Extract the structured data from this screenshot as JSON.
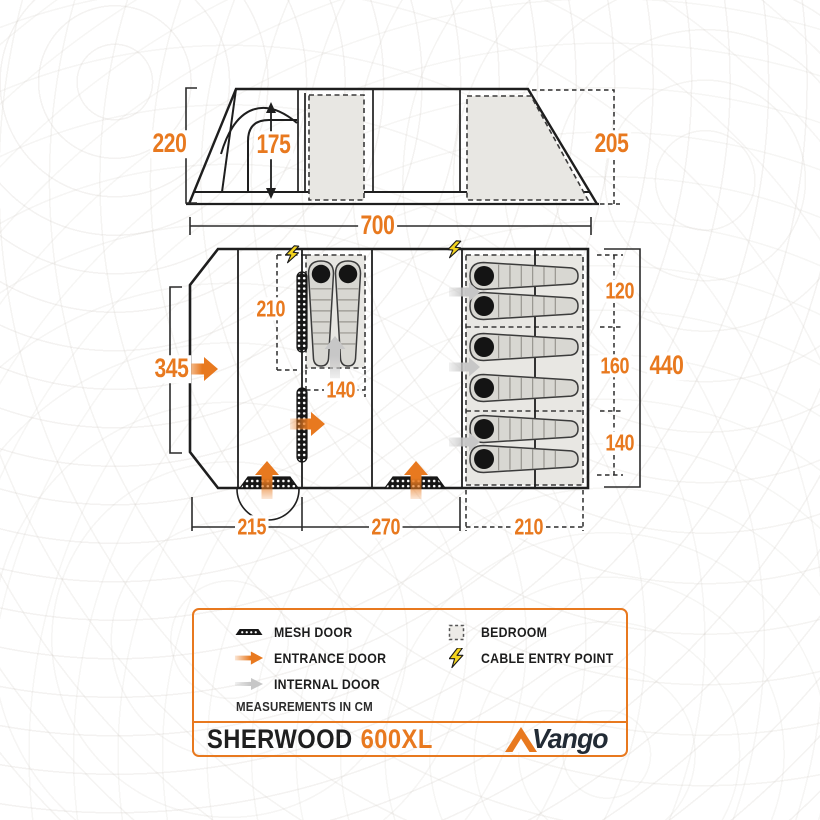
{
  "colors": {
    "accent_orange": "#e8791f",
    "bolt_yellow": "#f4d41f",
    "internal_gray": "#c7c7c7",
    "bedroom_fill": "#e8e7e3",
    "line_black": "#1e1e1e"
  },
  "icons": {
    "mesh_door": "mesh-door-icon",
    "entrance_door": "entrance-door-arrow-icon",
    "internal_door": "internal-door-arrow-icon",
    "bedroom": "bedroom-dashed-square-icon",
    "cable_entry": "lightning-bolt-icon",
    "brand_mark": "vango-triangle-icon"
  },
  "dims": {
    "elev_left_height": "220",
    "elev_inner_height": "175",
    "elev_right_height": "205",
    "total_width": "700",
    "front_width": "345",
    "bedroom_left_depth": "210",
    "bedroom_left_width": "140",
    "bottom_porch": "215",
    "bottom_living": "270",
    "bottom_bedroom": "210",
    "right_top": "120",
    "right_middle": "160",
    "right_bottom": "140",
    "right_total": "440"
  },
  "legend": {
    "items": [
      {
        "icon": "mesh-door-icon",
        "label": "MESH DOOR"
      },
      {
        "icon": "entrance-door-arrow-icon",
        "label": "ENTRANCE DOOR"
      },
      {
        "icon": "internal-door-arrow-icon",
        "label": "INTERNAL DOOR"
      },
      {
        "icon": "bedroom-dashed-square-icon",
        "label": "BEDROOM"
      },
      {
        "icon": "lightning-bolt-icon",
        "label": "CABLE ENTRY POINT"
      }
    ],
    "note": "MEASUREMENTS IN CM"
  },
  "footer": {
    "model": "SHERWOOD",
    "variant": "600XL",
    "brand": "Vango"
  }
}
